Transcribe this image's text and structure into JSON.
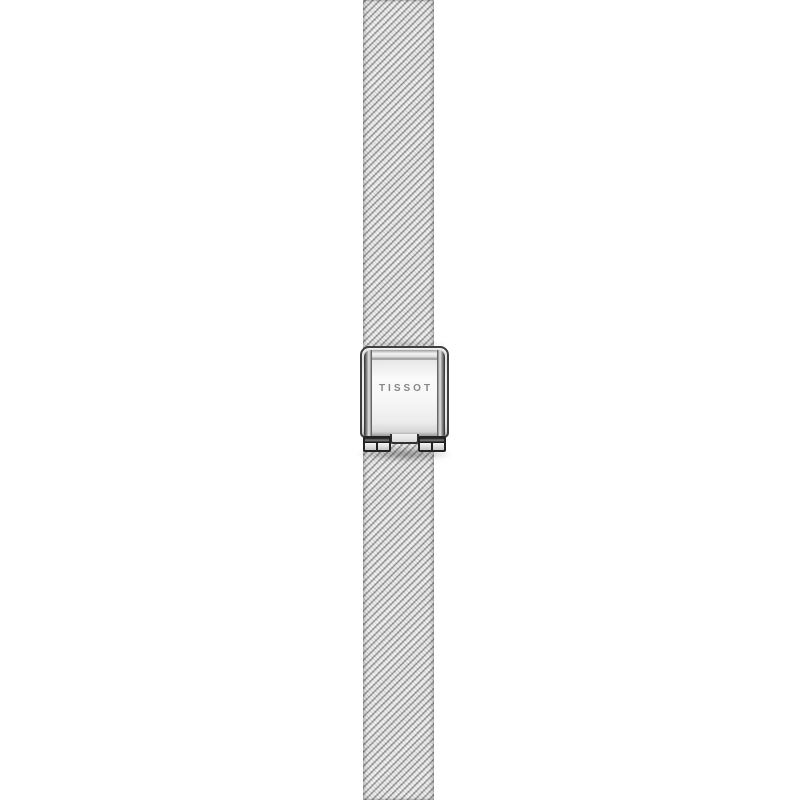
{
  "product": {
    "brand": "TISSOT",
    "description": "Stainless steel milanese mesh watch bracelet with engraved folding clasp, photographed vertically on white",
    "colors": {
      "background": "#ffffff",
      "mesh_base": "#d9d9d9",
      "mesh_dark_speckle": "#565656",
      "mesh_highlight": "#ffffff",
      "clasp_face": "#f7f7f7",
      "clasp_edge": "#3f3f3f",
      "clasp_hinge_dark": "#232323",
      "engraving_text": "#878787"
    }
  }
}
